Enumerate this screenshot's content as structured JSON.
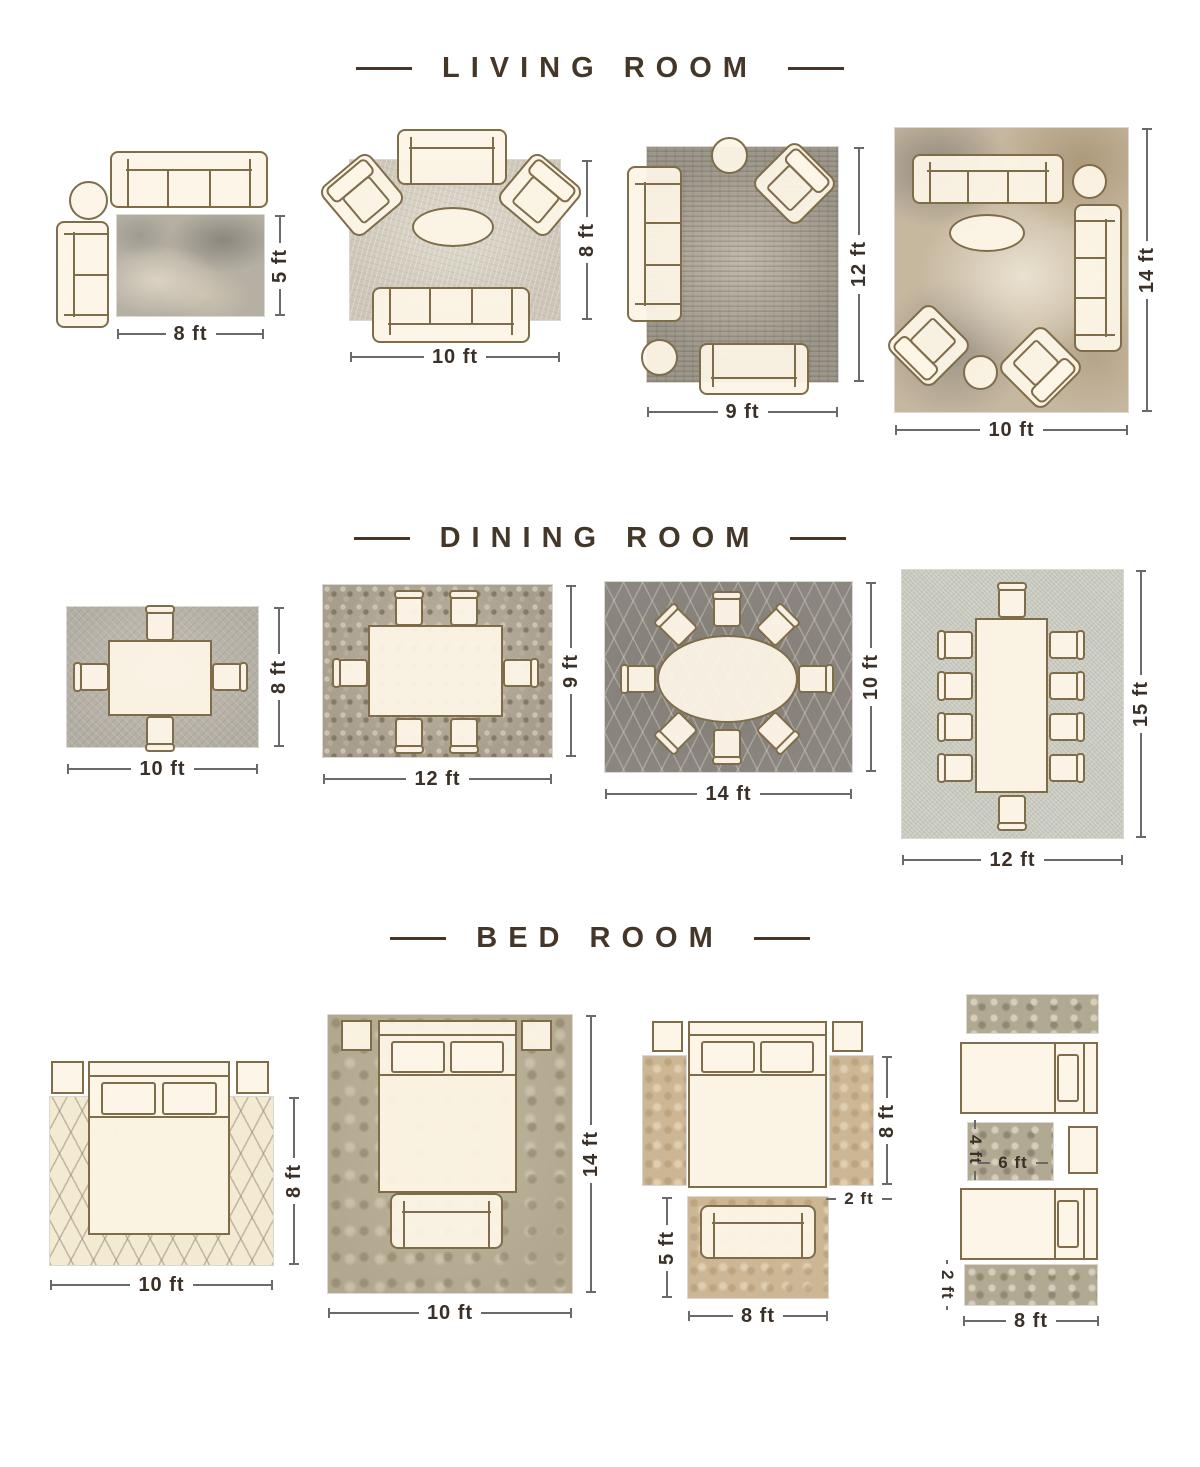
{
  "sections": [
    {
      "title": "LIVING ROOM",
      "layouts": [
        {
          "name": "living-sofa-set-8x5",
          "width_label": "8 ft",
          "height_label": "5 ft"
        },
        {
          "name": "living-sofa-set-10x8",
          "width_label": "10 ft",
          "height_label": "8 ft"
        },
        {
          "name": "living-sofa-set-9x12",
          "width_label": "9 ft",
          "height_label": "12 ft"
        },
        {
          "name": "living-sofa-set-10x14",
          "width_label": "10 ft",
          "height_label": "14 ft"
        }
      ]
    },
    {
      "title": "DINING ROOM",
      "layouts": [
        {
          "name": "dining-4-chair-10x8",
          "width_label": "10 ft",
          "height_label": "8 ft"
        },
        {
          "name": "dining-6-chair-12x9",
          "width_label": "12 ft",
          "height_label": "9 ft"
        },
        {
          "name": "dining-oval-8-chair-14x10",
          "width_label": "14 ft",
          "height_label": "10 ft"
        },
        {
          "name": "dining-10-chair-12x15",
          "width_label": "12 ft",
          "height_label": "15 ft"
        }
      ]
    },
    {
      "title": "BED ROOM",
      "layouts": [
        {
          "name": "bed-queen-10x8",
          "width_label": "10 ft",
          "height_label": "8 ft"
        },
        {
          "name": "bed-queen-10x14",
          "width_label": "10 ft",
          "height_label": "14 ft"
        },
        {
          "name": "bed-with-runners-and-sofa-rug",
          "runner_height_label": "8 ft",
          "runner_width_label": "2 ft",
          "sofa_rug_height_label": "5 ft",
          "sofa_rug_width_label": "8 ft"
        },
        {
          "name": "twin-beds-with-runners",
          "small_rug_height_label": "4 ft",
          "small_rug_width_label": "6 ft",
          "runner_height_label": "2 ft",
          "width_label": "8 ft"
        }
      ]
    }
  ],
  "colors": {
    "title_text": "#44372a",
    "label_text": "#3a3027",
    "dimension_line": "#6a6a6a",
    "furniture_fill": "#fdf5e7",
    "furniture_outline": "#7f6d4a",
    "rugs": {
      "living_8x5": [
        "#b6b0a4",
        "#ded5c4",
        "#848078"
      ],
      "living_10x8": [
        "#cdc6b9"
      ],
      "living_9x12": [
        "#9d968a",
        "#4a443a"
      ],
      "living_10x14": [
        "#c6b79f",
        "#8a847a",
        "#eee6d6",
        "#a89474"
      ],
      "dining_10x8": [
        "#b3aea4"
      ],
      "dining_12x9": [
        "#a89e8d",
        "#cec4b2",
        "#807664"
      ],
      "dining_14x10": [
        "#8b8680",
        "#d5d0c6"
      ],
      "dining_12x15": [
        "#c8c9be"
      ],
      "bed_10x8": [
        "#f3ead2",
        "#978578"
      ],
      "bed_10x14": [
        "#b1a88f",
        "#877c63"
      ],
      "bed_tan_runner": [
        "#ccb694",
        "#ac926c"
      ],
      "bed_gray_runner": [
        "#b2a993",
        "#756c5a"
      ]
    }
  }
}
